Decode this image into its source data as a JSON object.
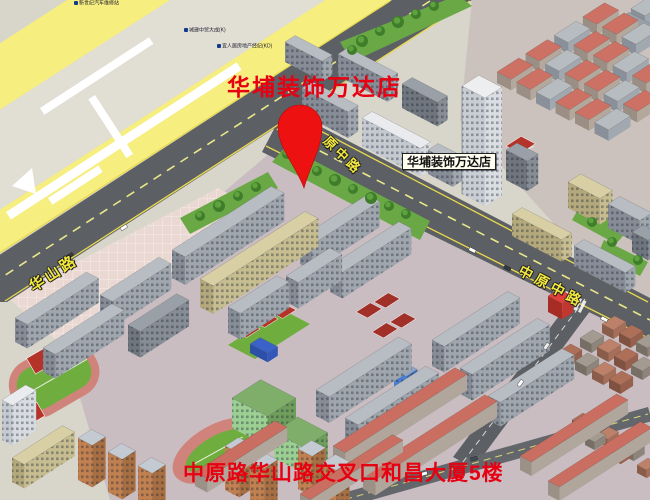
{
  "map": {
    "store_title": "华埔装饰万达店",
    "pin_label": "华埔装饰万达店",
    "address": "中原路华山路交叉口和昌大厦5楼",
    "roads": {
      "huashan": "华山路",
      "yuanzhong_partial": "原中路",
      "zhongyuan_middle": "中原中路"
    },
    "poi_labels": [
      "新世纪汽车维修站",
      "城建中贸大成(K)",
      "宜人居房地产经纪(KD)"
    ],
    "colors": {
      "title_red": "#e60012",
      "address_red": "#e60012",
      "pin_red": "#ed1111",
      "road_yellow": "#f6ee7e",
      "road_surface": "#5c6064",
      "road_edge_yellow": "#e8d94e",
      "road_name_yellow": "#f2e83e",
      "label_box_bg": "#fffdf0",
      "label_box_border": "#222222",
      "grass_green": "#6fae3e",
      "track_pink": "#cf837b",
      "court_red": "#b5342a",
      "tree_green": "#3f7d2b"
    }
  }
}
